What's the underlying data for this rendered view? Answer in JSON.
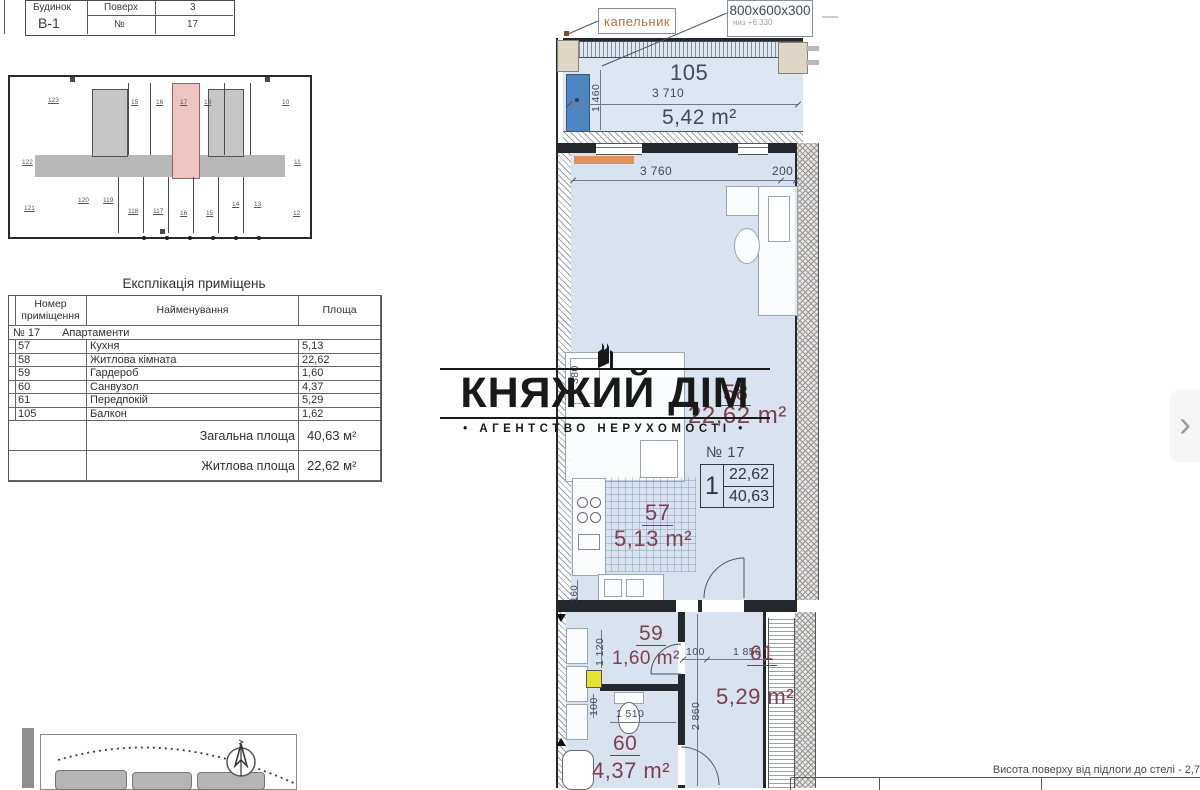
{
  "title_block": {
    "building_label": "Будинок",
    "building_value": "В-1",
    "floor_label": "Поверх",
    "floor_value": "3",
    "number_label": "№",
    "number_value": "17"
  },
  "overview": {
    "top_units": [
      "123",
      "15",
      "16",
      "17",
      "18",
      "10"
    ],
    "mid_left": "122",
    "mid_right": "11",
    "bottom_units": [
      "121",
      "120",
      "119",
      "118",
      "117",
      "16",
      "15",
      "14",
      "13",
      "12"
    ],
    "highlight_color": "#f0c3c3"
  },
  "explication": {
    "title": "Експлікація приміщень",
    "col_num": "Номер приміщення",
    "col_name": "Найменування",
    "col_area": "Площа",
    "group_num": "№ 17",
    "group_name": "Апартаменти",
    "rows": [
      {
        "num": "57",
        "name": "Кухня",
        "area": "5,13"
      },
      {
        "num": "58",
        "name": "Житлова кімната",
        "area": "22,62"
      },
      {
        "num": "59",
        "name": "Гардероб",
        "area": "1,60"
      },
      {
        "num": "60",
        "name": "Санвузол",
        "area": "4,37"
      },
      {
        "num": "61",
        "name": "Передпокій",
        "area": "5,29"
      },
      {
        "num": "105",
        "name": "Балкон",
        "area": "1,62"
      }
    ],
    "total_label": "Загальна площа",
    "total_value": "40,63 м²",
    "living_label": "Житлова площа",
    "living_value": "22,62 м²"
  },
  "logo": {
    "title": "КНЯЖИЙ ДІМ",
    "subtitle": "• АГЕНТСТВО НЕРУХОМОСТІ •"
  },
  "plan": {
    "callout_drip": "капельник",
    "callout_beam": "800х600х300",
    "callout_beam_sub": "низ +6.330",
    "balcony": {
      "number": "105",
      "width": "3 710",
      "area": "5,42 m²",
      "height_dim": "1 460"
    },
    "living": {
      "number": "58",
      "area": "22,62 m²",
      "width": "3 760",
      "offset": "200",
      "wall_dim": "380"
    },
    "kitchen": {
      "number": "57",
      "area": "5,13 m²",
      "dim": "160"
    },
    "wardrobe": {
      "number": "59",
      "area": "1,60 m²",
      "height_dim": "1 120",
      "door_dim": "100"
    },
    "bathroom": {
      "number": "60",
      "area": "4,37 m²",
      "width": "1 510",
      "door_dim": "100"
    },
    "hall": {
      "number": "61",
      "area": "5,29 m²",
      "width": "1 850",
      "height_dim": "2 860"
    },
    "stamp": {
      "label": "№ 17",
      "count": "1",
      "living": "22,62",
      "total": "40,63"
    },
    "accent_label_color": "#7c3f50",
    "room_fill_color": "#d9e3ef"
  },
  "footer": {
    "note": "Висота поверху від підлоги до стелі - 2,7"
  },
  "nav": {
    "next_arrow": "›"
  }
}
